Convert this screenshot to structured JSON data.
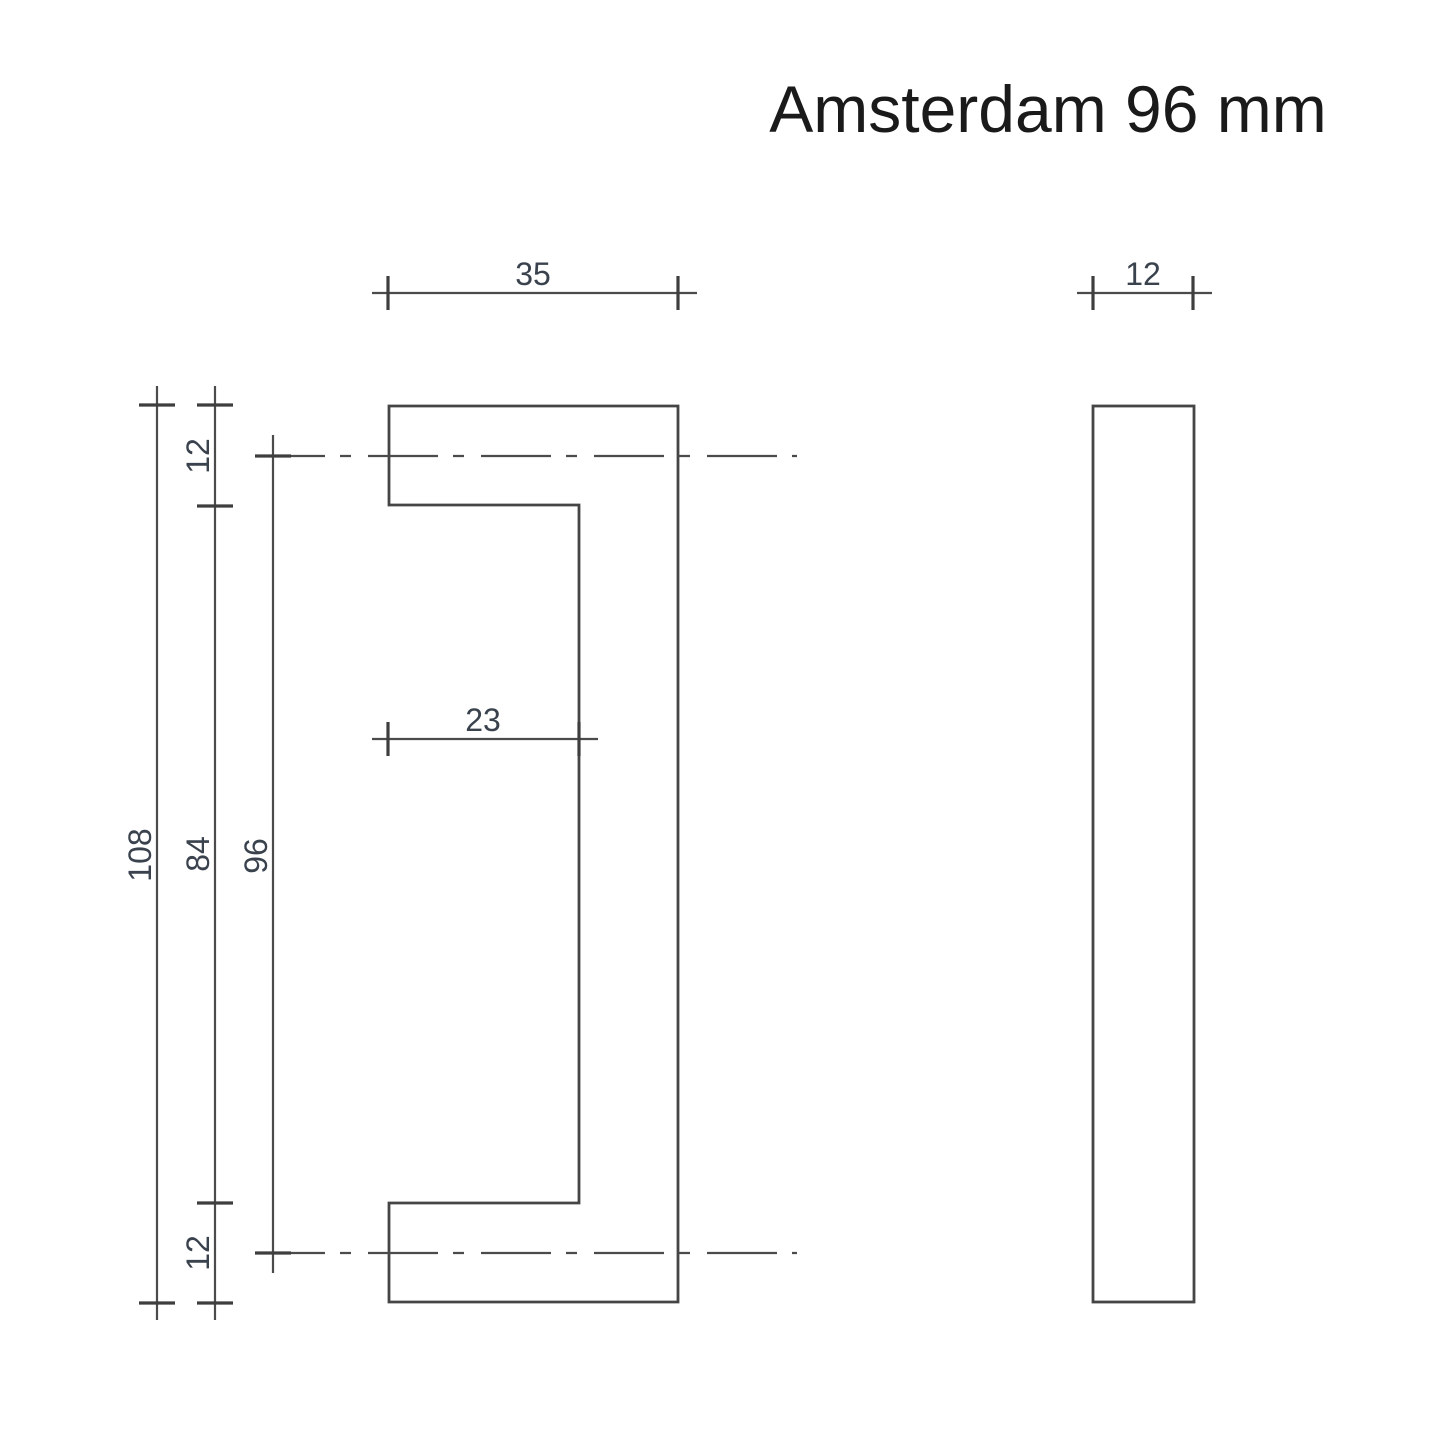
{
  "title": "Amsterdam 96 mm",
  "dimensions": {
    "front_width": "35",
    "side_thickness": "12",
    "inner_depth": "23",
    "overall_height": "108",
    "inner_height": "84",
    "hole_spacing": "96",
    "top_leg": "12",
    "bottom_leg": "12"
  },
  "colors": {
    "background": "#ffffff",
    "line": "#4b4b4b",
    "outline": "#454545",
    "tick": "#3e3e3e",
    "dimension_text": "#3a424d",
    "title_text": "#1a1a1a"
  }
}
